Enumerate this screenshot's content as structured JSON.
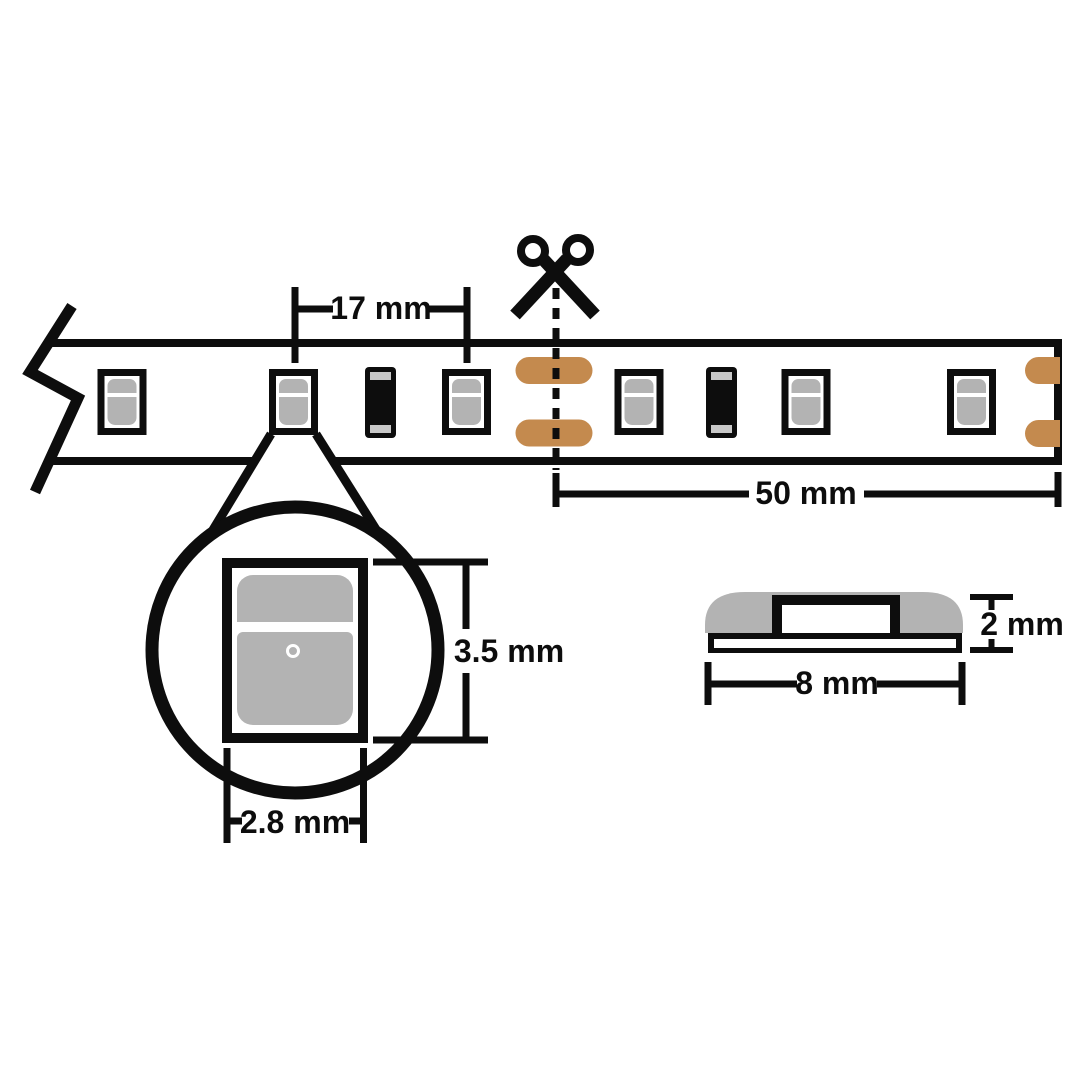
{
  "diagram": {
    "dimensions": {
      "led_pitch": "17 mm",
      "cut_length": "50 mm",
      "led_height": "3.5 mm",
      "led_width": "2.8 mm",
      "profile_height": "2 mm",
      "profile_width": "8 mm"
    },
    "colors": {
      "outline": "#0d0d0d",
      "component_gray": "#b3b3b3",
      "terminal_gray": "#c8c8c8",
      "copper_pad": "#c48a4e",
      "background": "#ffffff"
    },
    "strip": {
      "led_count": 6,
      "resistor_count": 2,
      "cut_pad_pairs": 1,
      "end_pad_pairs": 1
    }
  }
}
